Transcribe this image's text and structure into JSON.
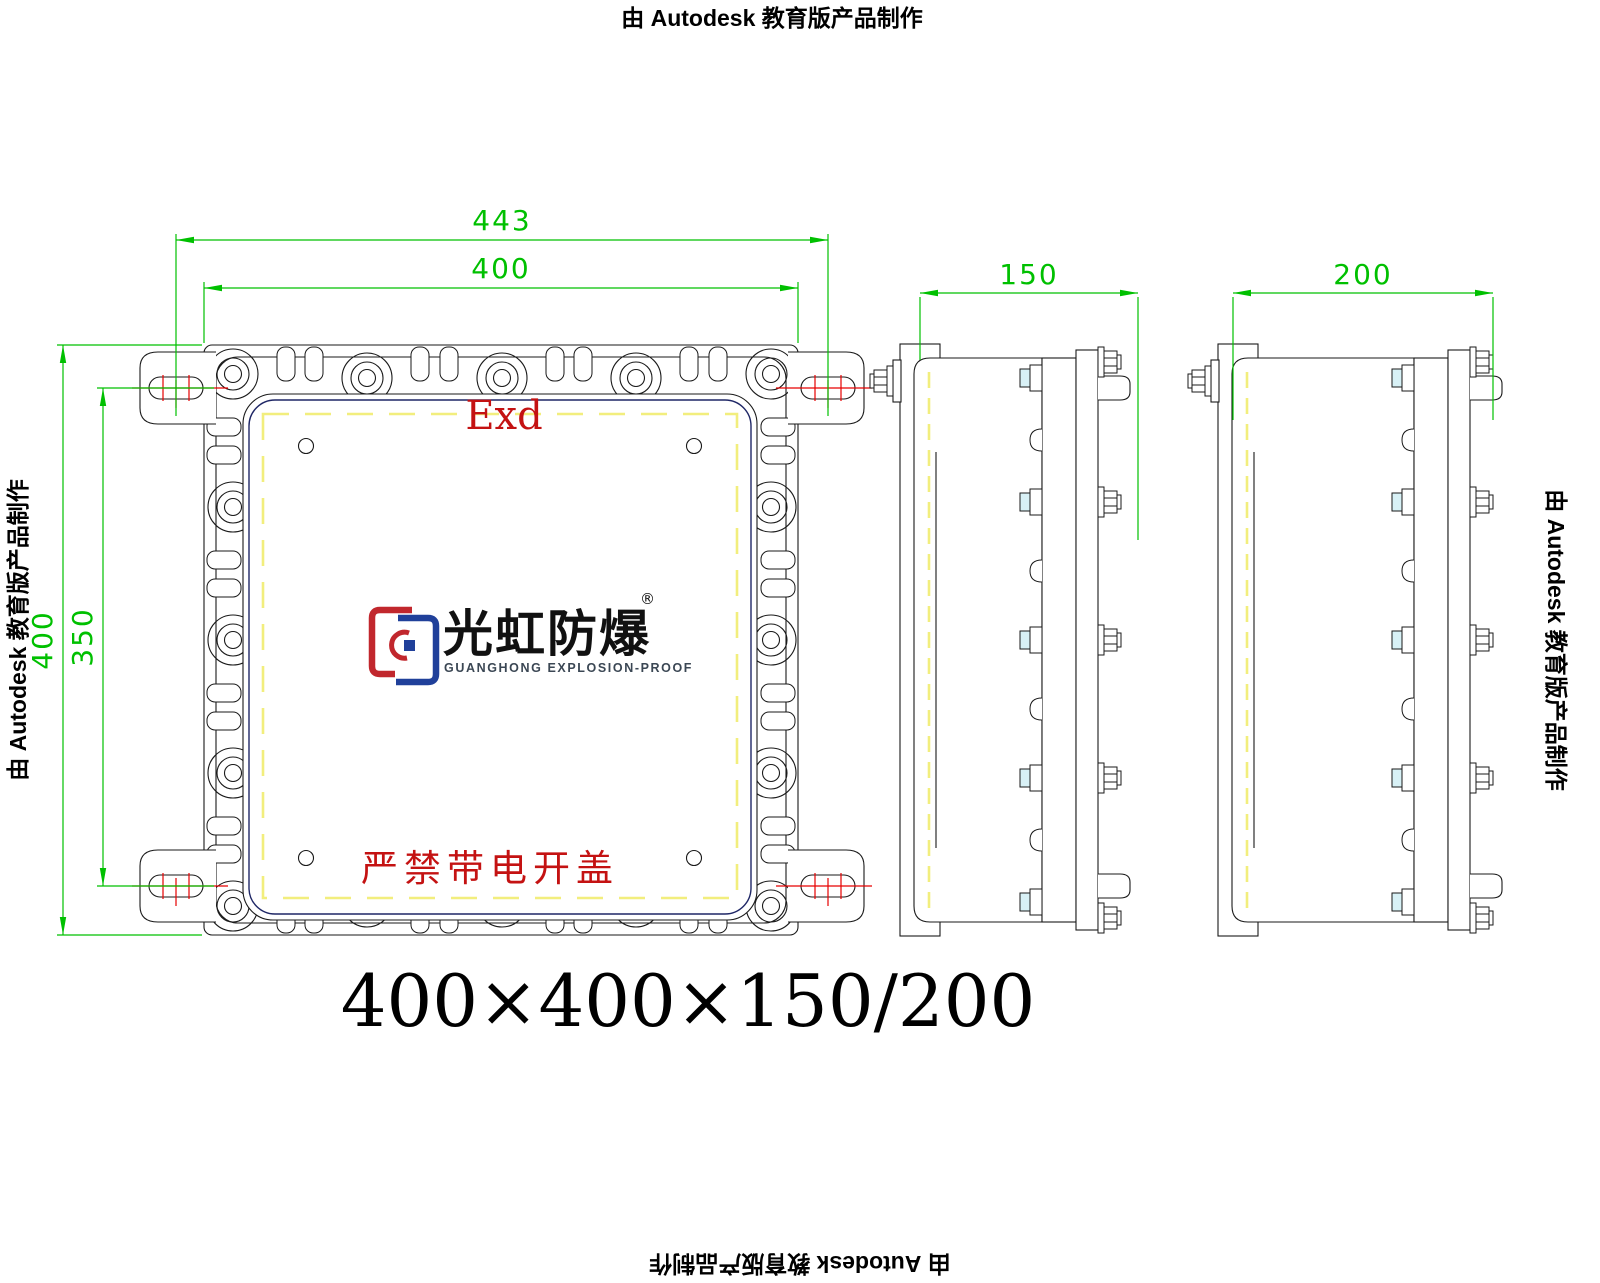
{
  "watermark": {
    "text": "由 Autodesk 教育版产品制作"
  },
  "title": {
    "text": "400×400×150/200"
  },
  "front_view": {
    "dim_overall_width": "443",
    "dim_width": "400",
    "dim_height": "400",
    "dim_mount_spacing": "350",
    "marking": "Exd",
    "warning": "严禁带电开盖"
  },
  "side_views": {
    "depth_1": "150",
    "depth_2": "200"
  },
  "logo": {
    "name_cn": "光虹防爆",
    "registered": "®",
    "name_en": "GUANGHONG EXPLOSION-PROOF"
  },
  "colors": {
    "dimension_green": "#00c000",
    "centerline_red": "#e60000",
    "marking_red": "#c41212",
    "gasket_yellow": "#f2ee7d",
    "cover_navy": "#1f2766",
    "bolt_cyan": "#d8f1f6",
    "logo_red": "#c1272d",
    "logo_blue": "#20409a"
  }
}
